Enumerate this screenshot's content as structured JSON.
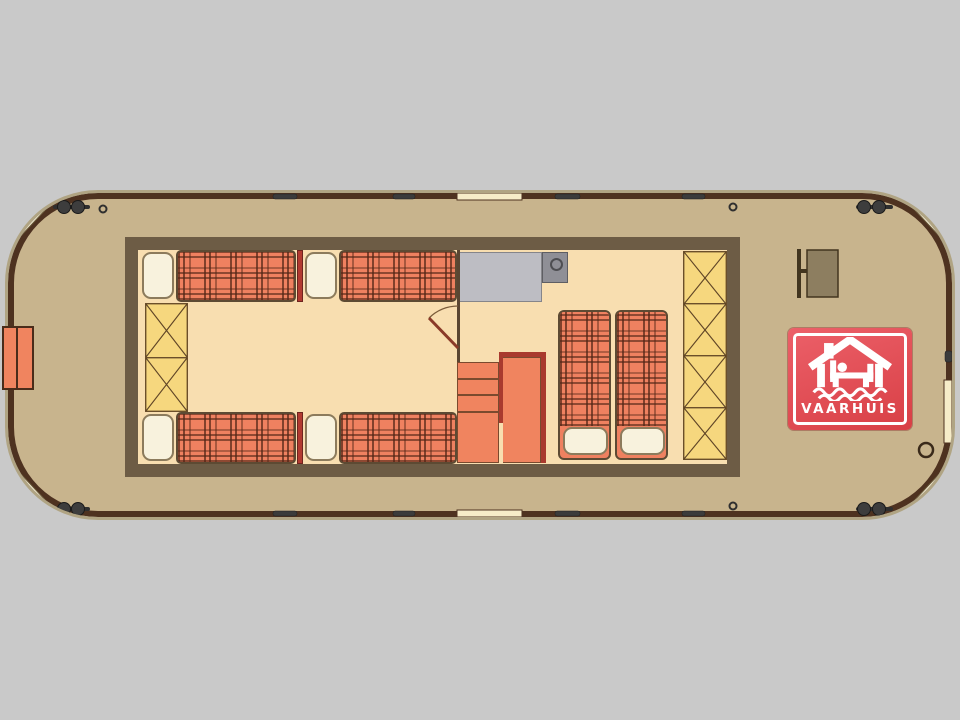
{
  "logo": {
    "label": "VAARHUIS",
    "icon": "houseboat-bed-waves-icon"
  },
  "plan": {
    "vessel": "houseboat deck plan",
    "berths_single": 4,
    "berths_double": 1,
    "storage_lockers_left": 2,
    "storage_lockers_right": 4,
    "mooring_cleat_pairs": 4
  },
  "colors": {
    "bg": "#c9c9c9",
    "deck": "#c8b48d",
    "hull-line": "#4e3220",
    "hull-trim": "#b0a483",
    "wall": "#6d5c45",
    "floor": "#f8deb0",
    "bed-base": "#ef8160",
    "pillow": "#f8f2dd",
    "pillow-line": "#8c7b5c",
    "red-divider": "#b23a31",
    "cabinet": "#f6d77e",
    "cabinet-line": "#6b4f2a",
    "counter": "#bdbdc3",
    "appliance": "#8f8f96",
    "stairs": "#f0845f",
    "stairs-red": "#a93a2e",
    "seat-cream": "#f8f3da",
    "cleat": "#3d3d3d",
    "logo-red-1": "#ec6069",
    "logo-red-2": "#d83f45"
  }
}
